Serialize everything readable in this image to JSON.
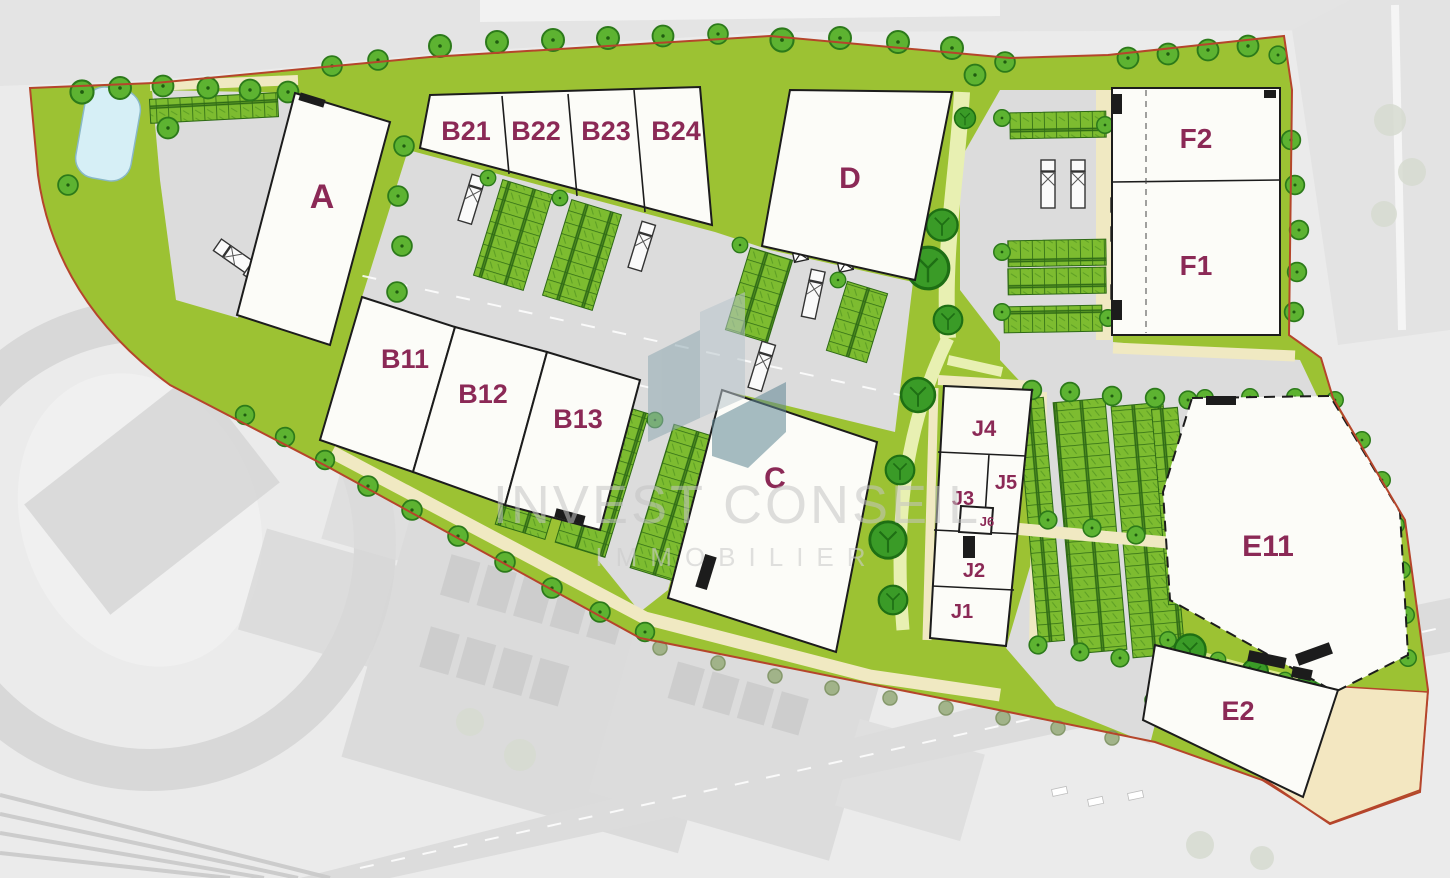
{
  "watermark": {
    "line1": "INVEST CONSEIL",
    "line2": "IMMOBILIER"
  },
  "buildings": {
    "a": {
      "label": "A"
    },
    "b11": {
      "label": "B11"
    },
    "b12": {
      "label": "B12"
    },
    "b13": {
      "label": "B13"
    },
    "b21": {
      "label": "B21"
    },
    "b22": {
      "label": "B22"
    },
    "b23": {
      "label": "B23"
    },
    "b24": {
      "label": "B24"
    },
    "c": {
      "label": "C"
    },
    "d": {
      "label": "D"
    },
    "e11": {
      "label": "E11"
    },
    "e2": {
      "label": "E2"
    },
    "f1": {
      "label": "F1"
    },
    "f2": {
      "label": "F2"
    },
    "j1": {
      "label": "J1"
    },
    "j2": {
      "label": "J2"
    },
    "j3": {
      "label": "J3"
    },
    "j4": {
      "label": "J4"
    },
    "j5": {
      "label": "J5"
    },
    "j6": {
      "label": "J6"
    }
  },
  "colors": {
    "site_green": "#9cc233",
    "path_pale_green": "#e8f0b2",
    "tree_green": "#5db331",
    "shrub_green": "#3a9b27",
    "stall_green": "#7dbc30",
    "building_fill": "#fcfcf8",
    "outline_black": "#1c1c1c",
    "boundary_red": "#b5452b",
    "label_purple": "#8b2956",
    "pond_blue": "#d6eff6",
    "sand_beige": "#f3e7c1",
    "path_beige": "#f0e9c2",
    "yard_gray": "#dcdcdc",
    "context_gray": "#ebebeb"
  }
}
